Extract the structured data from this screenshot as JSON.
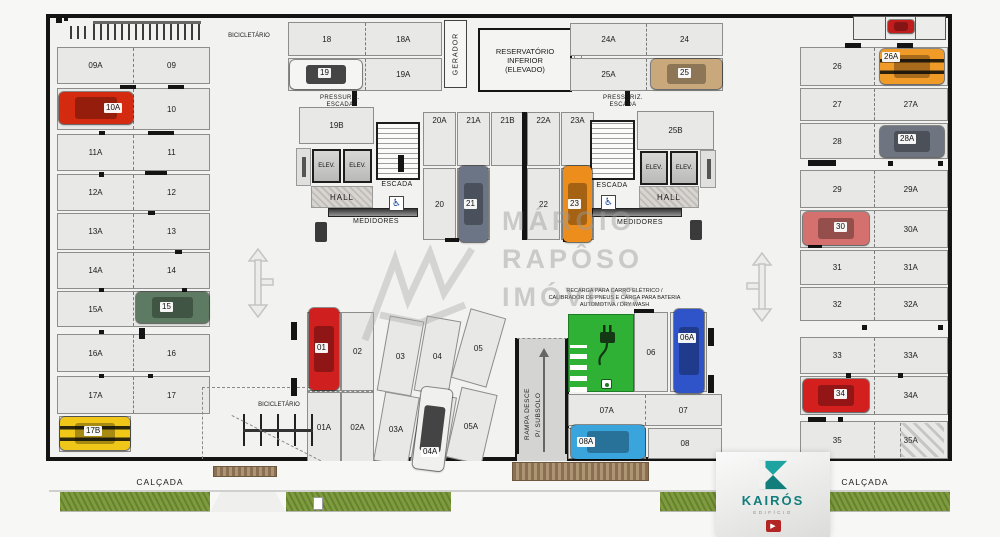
{
  "top": {
    "bicicletario_label": "BICICLETÁRIO",
    "pairs_left": [
      [
        "18",
        "18A"
      ],
      [
        "19",
        "19A"
      ]
    ],
    "gerador_label": "GERADOR",
    "reservatorio_lines": [
      "RESERVATÓRIO",
      "INFERIOR",
      "(ELEVADO)"
    ],
    "pairs_right": [
      [
        "24A",
        "24"
      ],
      [
        "25A",
        "25"
      ]
    ]
  },
  "left_col": {
    "rows": [
      [
        "09A",
        "09"
      ],
      [
        "10A",
        "10"
      ],
      [
        "11A",
        "11"
      ],
      [
        "12A",
        "12"
      ],
      [
        "13A",
        "13"
      ],
      [
        "14A",
        "14"
      ],
      [
        "15A",
        "15"
      ],
      [
        "16A",
        "16"
      ],
      [
        "17A",
        "17"
      ]
    ],
    "extra": "17B"
  },
  "right_col": {
    "rows": [
      [
        "26",
        "26A"
      ],
      [
        "27",
        "27A"
      ],
      [
        "28",
        "28A"
      ],
      [
        "29",
        "29A"
      ],
      [
        "30",
        "30A"
      ],
      [
        "31",
        "31A"
      ],
      [
        "32",
        "32A"
      ],
      [
        "33",
        "33A"
      ],
      [
        "34",
        "34A"
      ],
      [
        "35",
        "35A"
      ]
    ]
  },
  "core_left": {
    "pressuriz_lines": [
      "PRESSURIZ.",
      "ESCADA"
    ],
    "stall": "19B",
    "elev": "ELEV.",
    "escada": "ESCADA",
    "hall": "HALL",
    "medidores": "MEDIDORES",
    "access": "♿"
  },
  "core_right": {
    "pressuriz_lines": [
      "PRESSURIZ.",
      "ESCADA"
    ],
    "stall": "25B",
    "elev": "ELEV.",
    "escada": "ESCADA",
    "hall": "HALL",
    "medidores": "MEDIDORES",
    "access": "♿"
  },
  "mid": {
    "top": [
      "20A",
      "21A",
      "21B",
      "22A",
      "23A"
    ],
    "bottom": [
      "20",
      "21",
      "22",
      "23"
    ]
  },
  "bottom": {
    "v": [
      "01",
      "02"
    ],
    "va": [
      "01A",
      "02A"
    ],
    "slant": [
      "03",
      "04",
      "05"
    ],
    "slanta": [
      "03A",
      "04A",
      "05A"
    ],
    "ramp_lines": [
      "RAMPA  DESCE",
      "P/ SUBSOLO"
    ],
    "ev_lines": [
      "RECARGA PARA CARRO ELÉTRICO /",
      "CALIBRADOR DE PNEUS E CARGA PARA BATERIA",
      "AUTOMOTIVA / DRY WASH"
    ],
    "s06": "06",
    "s06a": "06A",
    "s07": "07",
    "s07a": "07A",
    "s08": "08",
    "s08a": "08A",
    "bicicletario_label": "BICICLETÁRIO"
  },
  "footer": {
    "calcada_left": "CALÇADA",
    "calcada_right": "CALÇADA"
  },
  "watermark": {
    "lines": [
      "MÁRCIO",
      "RAPÔSO",
      "IMÓVEIS"
    ]
  },
  "brand": {
    "name": "KAIRÓS",
    "subtitle": "EDIFÍCIO"
  },
  "palette": {
    "wall": "#141414",
    "ev_green": "#2eb135",
    "grass": "#7e9c3e",
    "teal": "#178f8c",
    "logo_red": "#b32424"
  }
}
